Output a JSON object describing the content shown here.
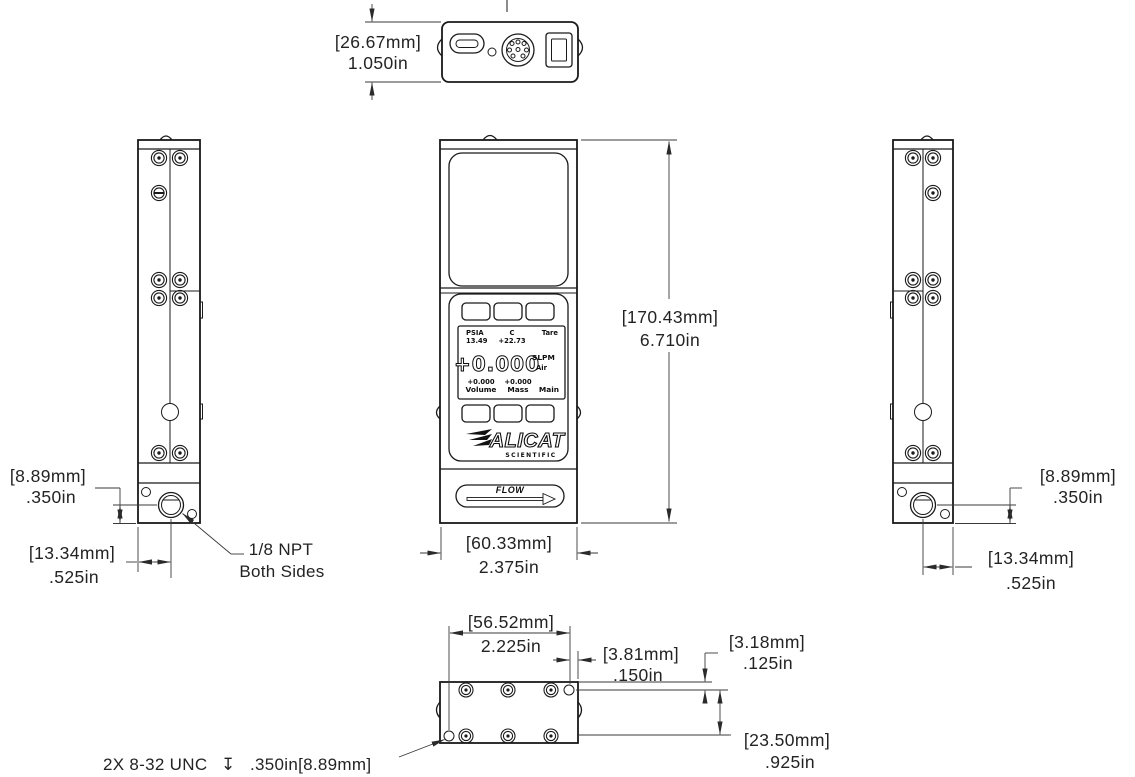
{
  "dims": {
    "top_width": {
      "mm": "[26.67mm]",
      "inch": "1.050in"
    },
    "height": {
      "mm": "[170.43mm]",
      "inch": "6.710in"
    },
    "front_width": {
      "mm": "[60.33mm]",
      "inch": "2.375in"
    },
    "port_height_left": {
      "mm": "[8.89mm]",
      "inch": ".350in"
    },
    "port_offset_left": {
      "mm": "[13.34mm]",
      "inch": ".525in"
    },
    "port_height_right": {
      "mm": "[8.89mm]",
      "inch": ".350in"
    },
    "port_offset_right": {
      "mm": "[13.34mm]",
      "inch": ".525in"
    },
    "bottom_span": {
      "mm": "[56.52mm]",
      "inch": "2.225in"
    },
    "bottom_edge": {
      "mm": "[3.81mm]",
      "inch": ".150in"
    },
    "bottom_top_offset": {
      "mm": "[3.18mm]",
      "inch": ".125in"
    },
    "bottom_rows": {
      "mm": "[23.50mm]",
      "inch": ".925in"
    }
  },
  "notes": {
    "npt1": "1/8 NPT",
    "npt2": "Both Sides",
    "thread": "2X 8-32 UNC",
    "depth_symbol": "↧",
    "thread_depth": ".350in[8.89mm]"
  },
  "display": {
    "pressure_label": "PSIA",
    "pressure_value": "13.49",
    "temp_label": "C",
    "temp_value": "+22.73",
    "tare_label": "Tare",
    "flow_value": "+0.000",
    "flow_unit": "SLPM",
    "gas_label": "Air",
    "volume_value": "+0.000",
    "volume_label": "Volume",
    "mass_value": "+0.000",
    "mass_label": "Mass",
    "main_label": "Main"
  },
  "branding": {
    "logo": "ALICAT",
    "sub": "SCIENTIFIC"
  },
  "flow": {
    "label": "FLOW"
  },
  "colors": {
    "line": "#1a1a1a",
    "background": "#ffffff"
  }
}
